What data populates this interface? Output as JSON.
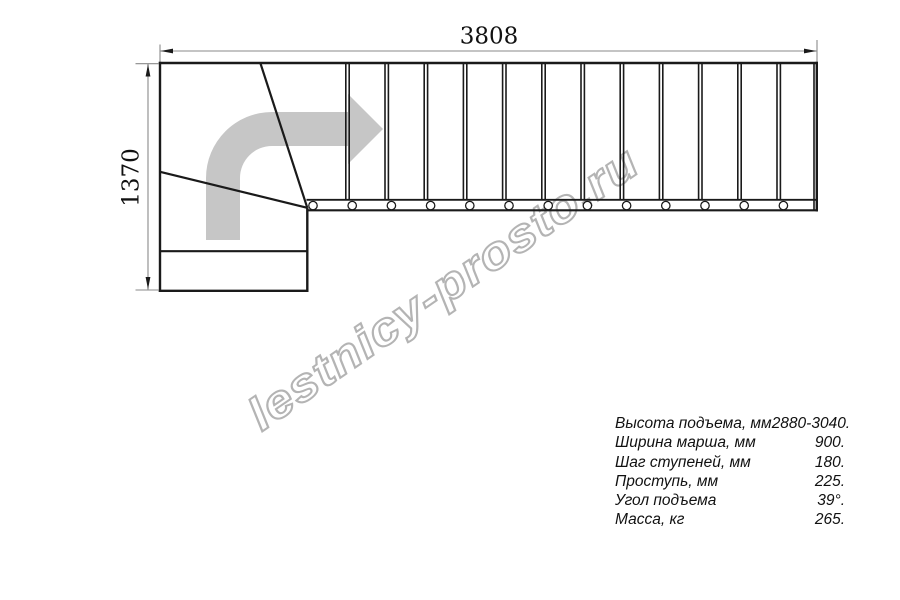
{
  "drawing": {
    "width_dim_label": "3808",
    "height_dim_label": "1370",
    "watermark_text": "lestnicy-prosto.ru",
    "flight": {
      "tread_edge_count": 12,
      "first_edge_x": 345.8,
      "spacing": 39.2,
      "pair_offset": 3.4,
      "edge_top_y": 63,
      "edge_bottom_y": 200
    },
    "balusters": {
      "count": 13,
      "first_cx": 313,
      "spacing": 39.2,
      "cy": 205.6,
      "r": 4.2
    }
  },
  "specs": {
    "rows": [
      {
        "label": "Высота подъема, мм",
        "value": "2880-3040."
      },
      {
        "label": "Ширина марша, мм",
        "value": "900."
      },
      {
        "label": "Шаг ступеней, мм",
        "value": "180."
      },
      {
        "label": "Проступь, мм",
        "value": "225."
      },
      {
        "label": "Угол подъема",
        "value": "39°."
      },
      {
        "label": "Масса, кг",
        "value": "265."
      }
    ]
  },
  "colors": {
    "line": "#1a1a1a",
    "dimension": "#8a8a8a",
    "arrow_fill": "#c6c6c6",
    "watermark": "#b4b4b4"
  }
}
